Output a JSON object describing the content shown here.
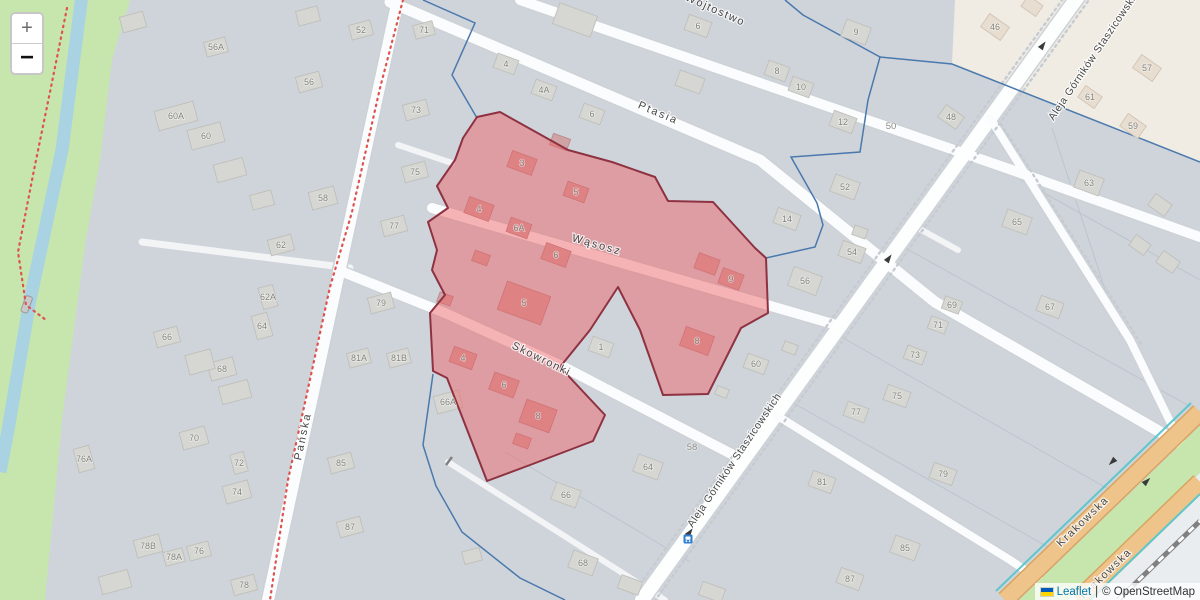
{
  "controls": {
    "zoom_in": "+",
    "zoom_out": "−"
  },
  "attribution": {
    "leaflet": "Leaflet",
    "separator": "|",
    "copyright": "© OpenStreetMap"
  },
  "colors": {
    "residential_bg": "#cfd4db",
    "nonresidential_bg": "#f0ece3",
    "grass": "#c6e6ae",
    "water": "#a9d2e2",
    "road": "#fbfcfd",
    "road_casing": "#cdd2d7",
    "primary_road": "#eec48b",
    "primary_casing": "#d8a45f",
    "railway": "#808080",
    "cycleway": "#5ec7cb",
    "boundary": "#4a79ad",
    "trail": "#e0524e",
    "highlight_fill": "#ef5a5e",
    "highlight_opacity": 0.45,
    "highlight_border": "#8e3242",
    "building_fill": "#d6d6d3",
    "building_stroke": "#bfbfba",
    "building_beige_fill": "#e7ddd0",
    "building_beige_stroke": "#d2c4b4",
    "building_pink_fill": "#cfa2a4",
    "building_pink_stroke": "#b98a8d",
    "bus_icon": "#2e7dd1",
    "arrow": "#3a3a3a"
  },
  "streets": [
    {
      "name": "Pańska",
      "x": 306,
      "y": 437,
      "rot": -78,
      "sp": 2,
      "size": 11
    },
    {
      "name": "Ptasia",
      "x": 657,
      "y": 116,
      "rot": 23,
      "sp": 2,
      "size": 11
    },
    {
      "name": "Wójtostwo",
      "x": 714,
      "y": 13,
      "rot": 24,
      "sp": 1.5,
      "size": 11
    },
    {
      "name": "Wąsosz",
      "x": 596,
      "y": 248,
      "rot": 16,
      "sp": 2,
      "size": 11
    },
    {
      "name": "Skowronki",
      "x": 540,
      "y": 362,
      "rot": 26,
      "sp": 1.5,
      "size": 11
    },
    {
      "name": "Aleja Górników Staszicowskich",
      "x": 737,
      "y": 462,
      "rot": -56,
      "sp": 0.5,
      "size": 10.5
    },
    {
      "name": "Aleja Górników Staszicowskich",
      "x": 1098,
      "y": 55,
      "rot": -56,
      "sp": 0.5,
      "size": 10.5
    },
    {
      "name": "Krakowska",
      "x": 1085,
      "y": 524,
      "rot": -44,
      "sp": 1.5,
      "size": 11
    },
    {
      "name": "Krakowska",
      "x": 1108,
      "y": 576,
      "rot": -44,
      "sp": 1.5,
      "size": 11
    }
  ],
  "area_labels": [
    {
      "label": "50",
      "x": 891,
      "y": 129
    },
    {
      "label": "58",
      "x": 692,
      "y": 450
    }
  ],
  "buildings": [
    {
      "n": "56A",
      "x": 216,
      "y": 47,
      "r": -15,
      "w": 22,
      "h": 15
    },
    {
      "n": "56",
      "x": 309,
      "y": 82,
      "r": -15,
      "w": 24,
      "h": 16
    },
    {
      "n": "52",
      "x": 361,
      "y": 30,
      "r": -15,
      "w": 22,
      "h": 15
    },
    {
      "n": "60A",
      "x": 176,
      "y": 116,
      "r": -15,
      "w": 40,
      "h": 20
    },
    {
      "n": "60",
      "x": 206,
      "y": 136,
      "r": -15,
      "w": 34,
      "h": 20
    },
    {
      "n": "58",
      "x": 323,
      "y": 198,
      "r": -15,
      "w": 26,
      "h": 18
    },
    {
      "n": "62",
      "x": 281,
      "y": 245,
      "r": -15,
      "w": 24,
      "h": 16
    },
    {
      "n": "62A",
      "x": 268,
      "y": 297,
      "r": 75,
      "w": 22,
      "h": 15
    },
    {
      "n": "64",
      "x": 262,
      "y": 326,
      "r": 75,
      "w": 24,
      "h": 16
    },
    {
      "n": "66",
      "x": 167,
      "y": 337,
      "r": -15,
      "w": 24,
      "h": 16
    },
    {
      "n": "68",
      "x": 222,
      "y": 369,
      "r": -15,
      "w": 26,
      "h": 18
    },
    {
      "n": "70",
      "x": 194,
      "y": 438,
      "r": -15,
      "w": 26,
      "h": 18
    },
    {
      "n": "72",
      "x": 239,
      "y": 463,
      "r": 75,
      "w": 20,
      "h": 14
    },
    {
      "n": "74",
      "x": 237,
      "y": 492,
      "r": -15,
      "w": 26,
      "h": 18
    },
    {
      "n": "76A",
      "x": 84,
      "y": 459,
      "r": 75,
      "w": 24,
      "h": 16
    },
    {
      "n": "78B",
      "x": 148,
      "y": 546,
      "r": -15,
      "w": 26,
      "h": 18
    },
    {
      "n": "78A",
      "x": 174,
      "y": 557,
      "r": -15,
      "w": 20,
      "h": 14
    },
    {
      "n": "76",
      "x": 199,
      "y": 551,
      "r": -15,
      "w": 22,
      "h": 15
    },
    {
      "n": "78",
      "x": 244,
      "y": 585,
      "r": -15,
      "w": 24,
      "h": 16
    },
    {
      "n": "71",
      "x": 424,
      "y": 30,
      "r": -15,
      "w": 20,
      "h": 14
    },
    {
      "n": "73",
      "x": 416,
      "y": 110,
      "r": -15,
      "w": 24,
      "h": 16
    },
    {
      "n": "75",
      "x": 415,
      "y": 172,
      "r": -15,
      "w": 24,
      "h": 16
    },
    {
      "n": "77",
      "x": 394,
      "y": 226,
      "r": -15,
      "w": 24,
      "h": 16
    },
    {
      "n": "79",
      "x": 381,
      "y": 303,
      "r": -15,
      "w": 24,
      "h": 16
    },
    {
      "n": "81A",
      "x": 359,
      "y": 358,
      "r": -15,
      "w": 22,
      "h": 15
    },
    {
      "n": "81B",
      "x": 399,
      "y": 358,
      "r": -15,
      "w": 22,
      "h": 15
    },
    {
      "n": "85",
      "x": 341,
      "y": 463,
      "r": -15,
      "w": 24,
      "h": 16
    },
    {
      "n": "87",
      "x": 350,
      "y": 527,
      "r": -15,
      "w": 24,
      "h": 16
    },
    {
      "n": "6",
      "x": 698,
      "y": 26,
      "r": 20,
      "w": 24,
      "h": 16
    },
    {
      "n": "9",
      "x": 856,
      "y": 32,
      "r": 20,
      "w": 26,
      "h": 18
    },
    {
      "n": "8",
      "x": 777,
      "y": 71,
      "r": 20,
      "w": 22,
      "h": 15
    },
    {
      "n": "10",
      "x": 801,
      "y": 87,
      "r": 20,
      "w": 22,
      "h": 15
    },
    {
      "n": "12",
      "x": 843,
      "y": 122,
      "r": 20,
      "w": 24,
      "h": 16
    },
    {
      "n": "4",
      "x": 506,
      "y": 64,
      "r": 20,
      "w": 22,
      "h": 15
    },
    {
      "n": "4A",
      "x": 544,
      "y": 90,
      "r": 20,
      "w": 22,
      "h": 15
    },
    {
      "n": "6",
      "x": 592,
      "y": 114,
      "r": 20,
      "w": 22,
      "h": 15
    },
    {
      "n": "52",
      "x": 845,
      "y": 187,
      "r": 20,
      "w": 26,
      "h": 18
    },
    {
      "n": "14",
      "x": 787,
      "y": 219,
      "r": 20,
      "w": 24,
      "h": 16
    },
    {
      "n": "54",
      "x": 852,
      "y": 252,
      "r": 20,
      "w": 24,
      "h": 16
    },
    {
      "n": "56",
      "x": 805,
      "y": 281,
      "r": 20,
      "w": 30,
      "h": 20
    },
    {
      "n": "1",
      "x": 601,
      "y": 347,
      "r": 20,
      "w": 22,
      "h": 15
    },
    {
      "n": "66A",
      "x": 448,
      "y": 402,
      "r": -15,
      "w": 26,
      "h": 18
    },
    {
      "n": "60",
      "x": 756,
      "y": 364,
      "r": 20,
      "w": 22,
      "h": 15
    },
    {
      "n": "64",
      "x": 648,
      "y": 467,
      "r": 20,
      "w": 26,
      "h": 18
    },
    {
      "n": "66",
      "x": 566,
      "y": 495,
      "r": 20,
      "w": 26,
      "h": 18
    },
    {
      "n": "68",
      "x": 583,
      "y": 563,
      "r": 20,
      "w": 26,
      "h": 18
    },
    {
      "n": "63",
      "x": 1089,
      "y": 183,
      "r": 20,
      "w": 26,
      "h": 18
    },
    {
      "n": "65",
      "x": 1017,
      "y": 222,
      "r": 20,
      "w": 26,
      "h": 18
    },
    {
      "n": "67",
      "x": 1050,
      "y": 307,
      "r": 20,
      "w": 24,
      "h": 16
    },
    {
      "n": "69",
      "x": 952,
      "y": 305,
      "r": 20,
      "w": 18,
      "h": 13
    },
    {
      "n": "71",
      "x": 938,
      "y": 325,
      "r": 20,
      "w": 18,
      "h": 13
    },
    {
      "n": "73",
      "x": 915,
      "y": 355,
      "r": 20,
      "w": 20,
      "h": 14
    },
    {
      "n": "75",
      "x": 897,
      "y": 396,
      "r": 20,
      "w": 24,
      "h": 16
    },
    {
      "n": "77",
      "x": 856,
      "y": 412,
      "r": 20,
      "w": 22,
      "h": 15
    },
    {
      "n": "79",
      "x": 943,
      "y": 474,
      "r": 20,
      "w": 24,
      "h": 16
    },
    {
      "n": "81",
      "x": 822,
      "y": 482,
      "r": 20,
      "w": 24,
      "h": 16
    },
    {
      "n": "85",
      "x": 905,
      "y": 548,
      "r": 20,
      "w": 26,
      "h": 18
    },
    {
      "n": "87",
      "x": 850,
      "y": 579,
      "r": 20,
      "w": 24,
      "h": 16
    },
    {
      "n": "46",
      "x": 995,
      "y": 27,
      "r": 35,
      "w": 24,
      "h": 16,
      "z": "b"
    },
    {
      "n": "48",
      "x": 951,
      "y": 117,
      "r": 35,
      "w": 22,
      "h": 15
    },
    {
      "n": "57",
      "x": 1147,
      "y": 68,
      "r": 35,
      "w": 24,
      "h": 16,
      "z": "b"
    },
    {
      "n": "59",
      "x": 1133,
      "y": 126,
      "r": 35,
      "w": 22,
      "h": 15,
      "z": "b"
    },
    {
      "n": "61",
      "x": 1090,
      "y": 97,
      "r": 35,
      "w": 20,
      "h": 14,
      "z": "b"
    },
    {
      "n": "",
      "x": 1032,
      "y": 6,
      "r": 35,
      "w": 18,
      "h": 13,
      "z": "b"
    },
    {
      "n": "",
      "x": 575,
      "y": 20,
      "r": 20,
      "w": 40,
      "h": 22
    },
    {
      "n": "",
      "x": 690,
      "y": 82,
      "r": 20,
      "w": 26,
      "h": 16
    },
    {
      "n": "",
      "x": 133,
      "y": 22,
      "r": -15,
      "w": 24,
      "h": 16
    },
    {
      "n": "",
      "x": 308,
      "y": 16,
      "r": -15,
      "w": 22,
      "h": 15
    },
    {
      "n": "",
      "x": 230,
      "y": 170,
      "r": -15,
      "w": 30,
      "h": 18
    },
    {
      "n": "",
      "x": 262,
      "y": 200,
      "r": -15,
      "w": 22,
      "h": 15
    },
    {
      "n": "",
      "x": 200,
      "y": 362,
      "r": -15,
      "w": 26,
      "h": 20
    },
    {
      "n": "",
      "x": 235,
      "y": 392,
      "r": -15,
      "w": 30,
      "h": 18
    },
    {
      "n": "",
      "x": 115,
      "y": 582,
      "r": -15,
      "w": 30,
      "h": 18
    },
    {
      "n": "",
      "x": 630,
      "y": 585,
      "r": 20,
      "w": 22,
      "h": 14
    },
    {
      "n": "",
      "x": 712,
      "y": 592,
      "r": 20,
      "w": 24,
      "h": 14
    },
    {
      "n": "",
      "x": 472,
      "y": 556,
      "r": -15,
      "w": 18,
      "h": 13
    },
    {
      "n": "",
      "x": 860,
      "y": 232,
      "r": 20,
      "w": 14,
      "h": 10
    },
    {
      "n": "",
      "x": 1160,
      "y": 205,
      "r": 35,
      "w": 20,
      "h": 14
    },
    {
      "n": "",
      "x": 1140,
      "y": 245,
      "r": 35,
      "w": 18,
      "h": 13
    },
    {
      "n": "",
      "x": 1168,
      "y": 262,
      "r": 35,
      "w": 20,
      "h": 14
    },
    {
      "n": "",
      "x": 790,
      "y": 348,
      "r": 20,
      "w": 14,
      "h": 10
    },
    {
      "n": "",
      "x": 722,
      "y": 392,
      "r": 20,
      "w": 12,
      "h": 9
    },
    {
      "n": "3",
      "x": 522,
      "y": 163,
      "r": 20,
      "w": 26,
      "h": 17,
      "z": "p"
    },
    {
      "n": "5",
      "x": 576,
      "y": 192,
      "r": 20,
      "w": 22,
      "h": 15,
      "z": "p"
    },
    {
      "n": "4",
      "x": 479,
      "y": 209,
      "r": 20,
      "w": 26,
      "h": 17,
      "z": "p"
    },
    {
      "n": "6A",
      "x": 519,
      "y": 228,
      "r": 20,
      "w": 22,
      "h": 15,
      "z": "p"
    },
    {
      "n": "6",
      "x": 556,
      "y": 255,
      "r": 20,
      "w": 26,
      "h": 17,
      "z": "p"
    },
    {
      "n": "9",
      "x": 731,
      "y": 279,
      "r": 20,
      "w": 22,
      "h": 16,
      "z": "p"
    },
    {
      "n": "",
      "x": 707,
      "y": 264,
      "r": 20,
      "w": 22,
      "h": 16,
      "z": "p"
    },
    {
      "n": "5",
      "x": 524,
      "y": 303,
      "r": 20,
      "w": 46,
      "h": 30,
      "z": "p"
    },
    {
      "n": "4",
      "x": 463,
      "y": 358,
      "r": 20,
      "w": 24,
      "h": 16,
      "z": "p"
    },
    {
      "n": "6",
      "x": 504,
      "y": 385,
      "r": 20,
      "w": 26,
      "h": 18,
      "z": "p"
    },
    {
      "n": "8",
      "x": 538,
      "y": 416,
      "r": 20,
      "w": 32,
      "h": 24,
      "z": "p"
    },
    {
      "n": "8",
      "x": 697,
      "y": 341,
      "r": 20,
      "w": 30,
      "h": 20,
      "z": "p"
    },
    {
      "n": "",
      "x": 560,
      "y": 142,
      "r": 20,
      "w": 18,
      "h": 12,
      "z": "p"
    },
    {
      "n": "",
      "x": 481,
      "y": 258,
      "r": 20,
      "w": 16,
      "h": 11,
      "z": "p"
    },
    {
      "n": "",
      "x": 445,
      "y": 299,
      "r": 20,
      "w": 14,
      "h": 10,
      "z": "p"
    },
    {
      "n": "",
      "x": 522,
      "y": 441,
      "r": 20,
      "w": 16,
      "h": 11,
      "z": "p"
    }
  ],
  "icons": {
    "oneway_arrows": [
      {
        "x": 690,
        "y": 532,
        "rot": -54
      },
      {
        "x": 889,
        "y": 258,
        "rot": -54
      },
      {
        "x": 1043,
        "y": 45,
        "rot": -54
      },
      {
        "x": 1112,
        "y": 462,
        "rot": 136
      },
      {
        "x": 1147,
        "y": 481,
        "rot": -44
      }
    ],
    "bus_stop": {
      "x": 688,
      "y": 539
    }
  }
}
